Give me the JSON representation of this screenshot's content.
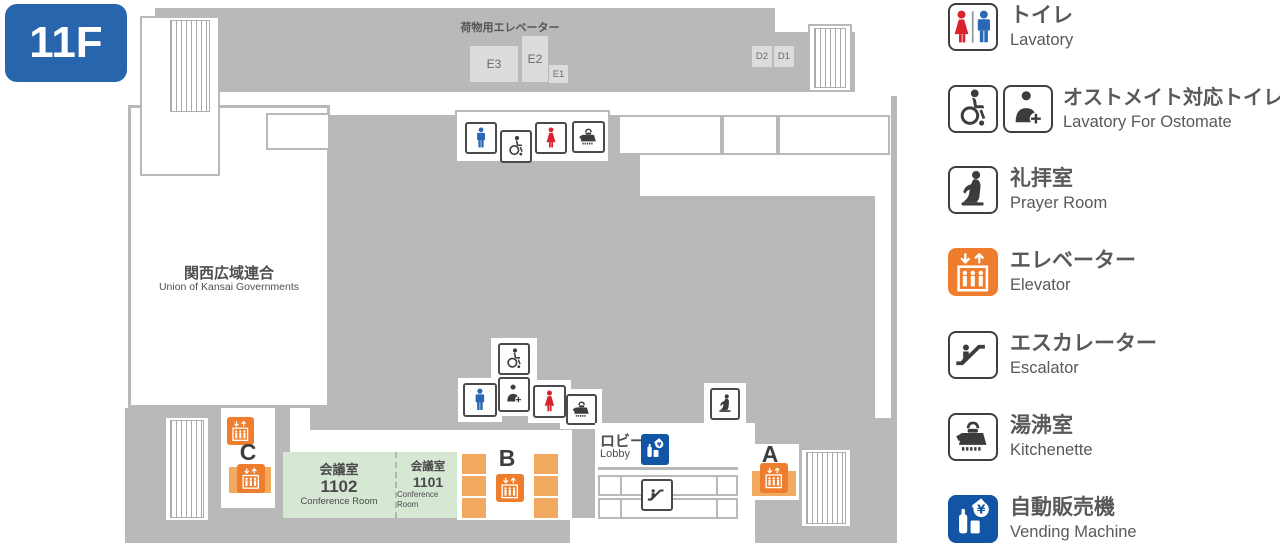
{
  "floor_badge": "11F",
  "plan": {
    "cargo_elevator_label": "荷物用エレベーター",
    "cargo_cars": [
      "E3",
      "E2",
      "E1"
    ],
    "d_cars": [
      "D2",
      "D1"
    ],
    "union_room": {
      "jp": "関西広域連合",
      "en": "Union of Kansai Governments"
    },
    "conference_1102": {
      "jp": "会議室",
      "number": "1102",
      "en": "Conference Room"
    },
    "conference_1101": {
      "jp": "会議室",
      "number": "1101",
      "en": "Conference Room"
    },
    "lobby": {
      "jp": "ロビー",
      "en": "Lobby"
    },
    "banks": {
      "a": "A",
      "b": "B",
      "c": "C"
    }
  },
  "legend": {
    "items": [
      {
        "jp": "トイレ",
        "en": "Lavatory",
        "icon": "lavatory"
      },
      {
        "jp": "オストメイト対応トイレ",
        "en": "Lavatory For Ostomate",
        "icon": "ostomate"
      },
      {
        "jp": "礼拝室",
        "en": "Prayer Room",
        "icon": "prayer"
      },
      {
        "jp": "エレベーター",
        "en": "Elevator",
        "icon": "elevator"
      },
      {
        "jp": "エスカレーター",
        "en": "Escalator",
        "icon": "escalator"
      },
      {
        "jp": "湯沸室",
        "en": "Kitchenette",
        "icon": "kettle"
      },
      {
        "jp": "自動販売機",
        "en": "Vending Machine",
        "icon": "vending"
      }
    ]
  },
  "colors": {
    "badge_blue": "#2766ac",
    "wall_gray": "#b9b9b9",
    "elevator_orange": "#ee7d2e",
    "elevator_light_orange": "#f2aa60",
    "vending_blue": "#1155a4",
    "man_blue": "#2a68b5",
    "woman_red": "#d8232f",
    "room_green": "#d6e7d4"
  }
}
